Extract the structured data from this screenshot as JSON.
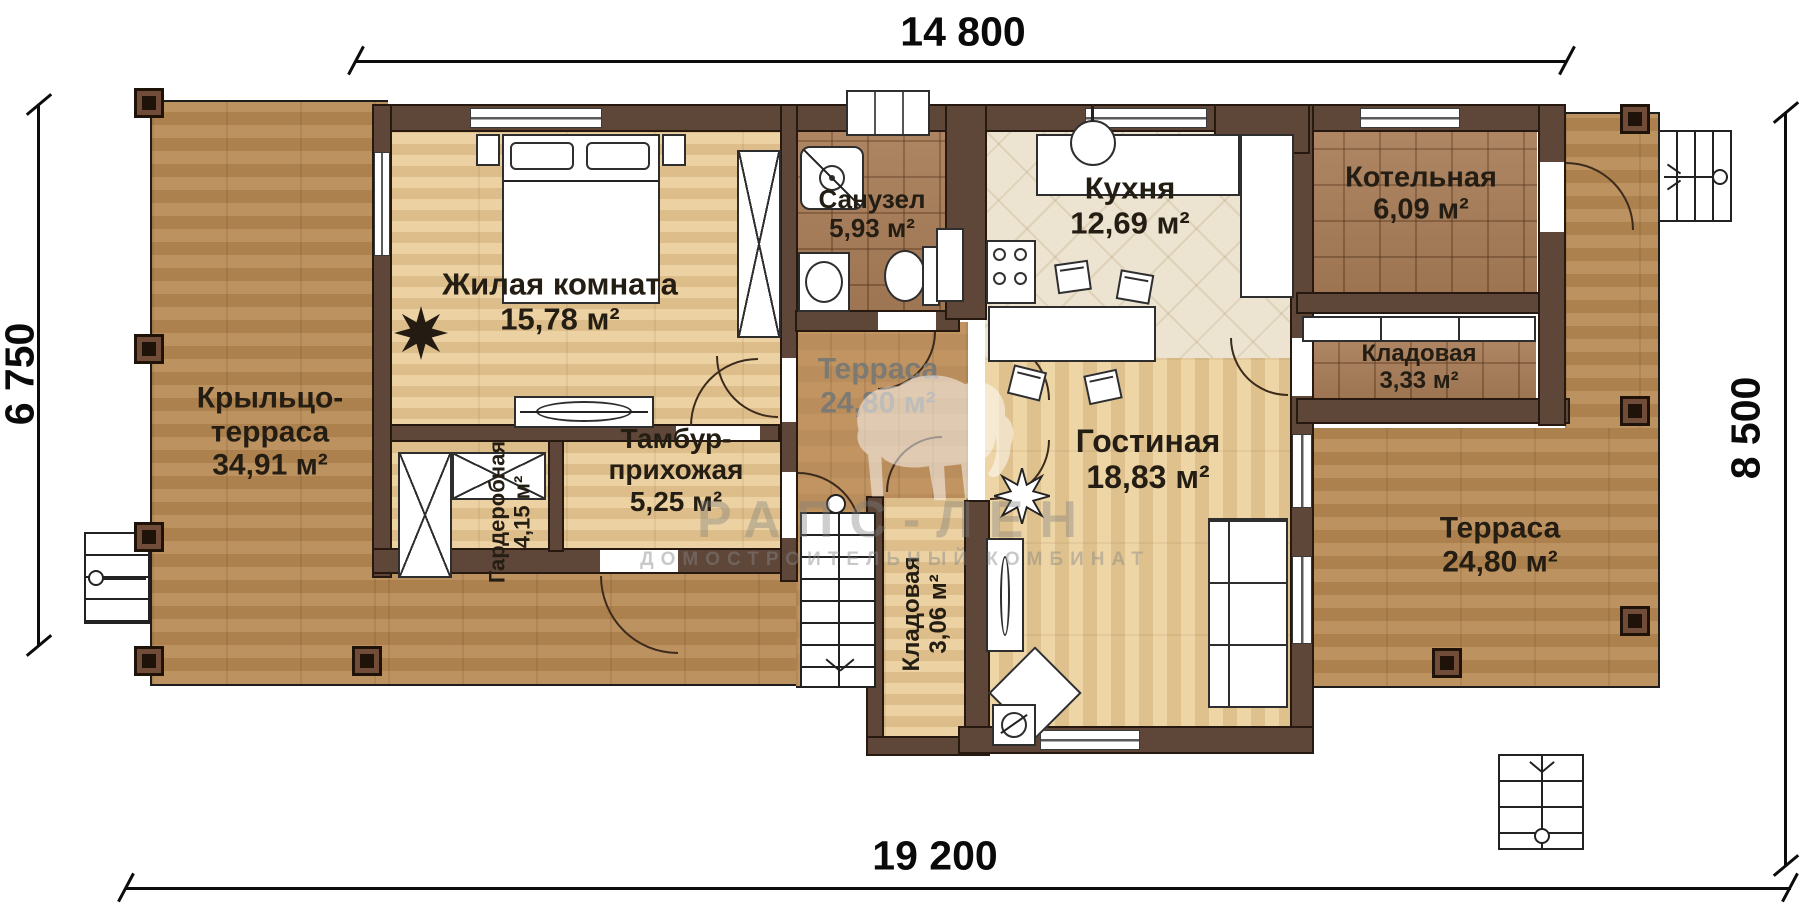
{
  "dimensions": {
    "top": "14 800",
    "left": "6 750",
    "right": "8 500",
    "bottom": "19 200"
  },
  "watermark": {
    "brand": "РАПС-ЛЕН",
    "subtitle": "ДОМОСТРОИТЕЛЬНЫЙ КОМБИНАТ"
  },
  "colors": {
    "wall": "#5e4639",
    "deck_wood": "#b98e5e",
    "light_wood": "#e8cd9e",
    "brown_tile": "#a87d58",
    "kitchen_floor": "#ece3d0",
    "label_text": "#241d13",
    "terrace_label_gray": "#7d7a74"
  },
  "rooms": [
    {
      "id": "porch-terrace",
      "line1": "Крыльцо-",
      "line2": "терраса",
      "area": "34,91 м²"
    },
    {
      "id": "living-room",
      "name": "Жилая комната",
      "area": "15,78 м²"
    },
    {
      "id": "bathroom",
      "name": "Санузел",
      "area": "5,93 м²"
    },
    {
      "id": "kitchen",
      "name": "Кухня",
      "area": "12,69 м²"
    },
    {
      "id": "boiler-room",
      "name": "Котельная",
      "area": "6,09 м²"
    },
    {
      "id": "storage-north",
      "name": "Кладовая",
      "area": "3,33 м²"
    },
    {
      "id": "terrace-middle",
      "name": "Терраса",
      "area": "24,80 м²"
    },
    {
      "id": "wardrobe",
      "name": "Гардеробная",
      "area": "4,15 м²"
    },
    {
      "id": "vestibule",
      "line1": "Тамбур-",
      "line2": "прихожая",
      "area": "5,25 м²"
    },
    {
      "id": "storage-south",
      "name": "Кладовая",
      "area": "3,06 м²"
    },
    {
      "id": "lounge",
      "name": "Гостиная",
      "area": "18,83 м²"
    },
    {
      "id": "terrace-right",
      "name": "Терраса",
      "area": "24,80 м²"
    }
  ]
}
